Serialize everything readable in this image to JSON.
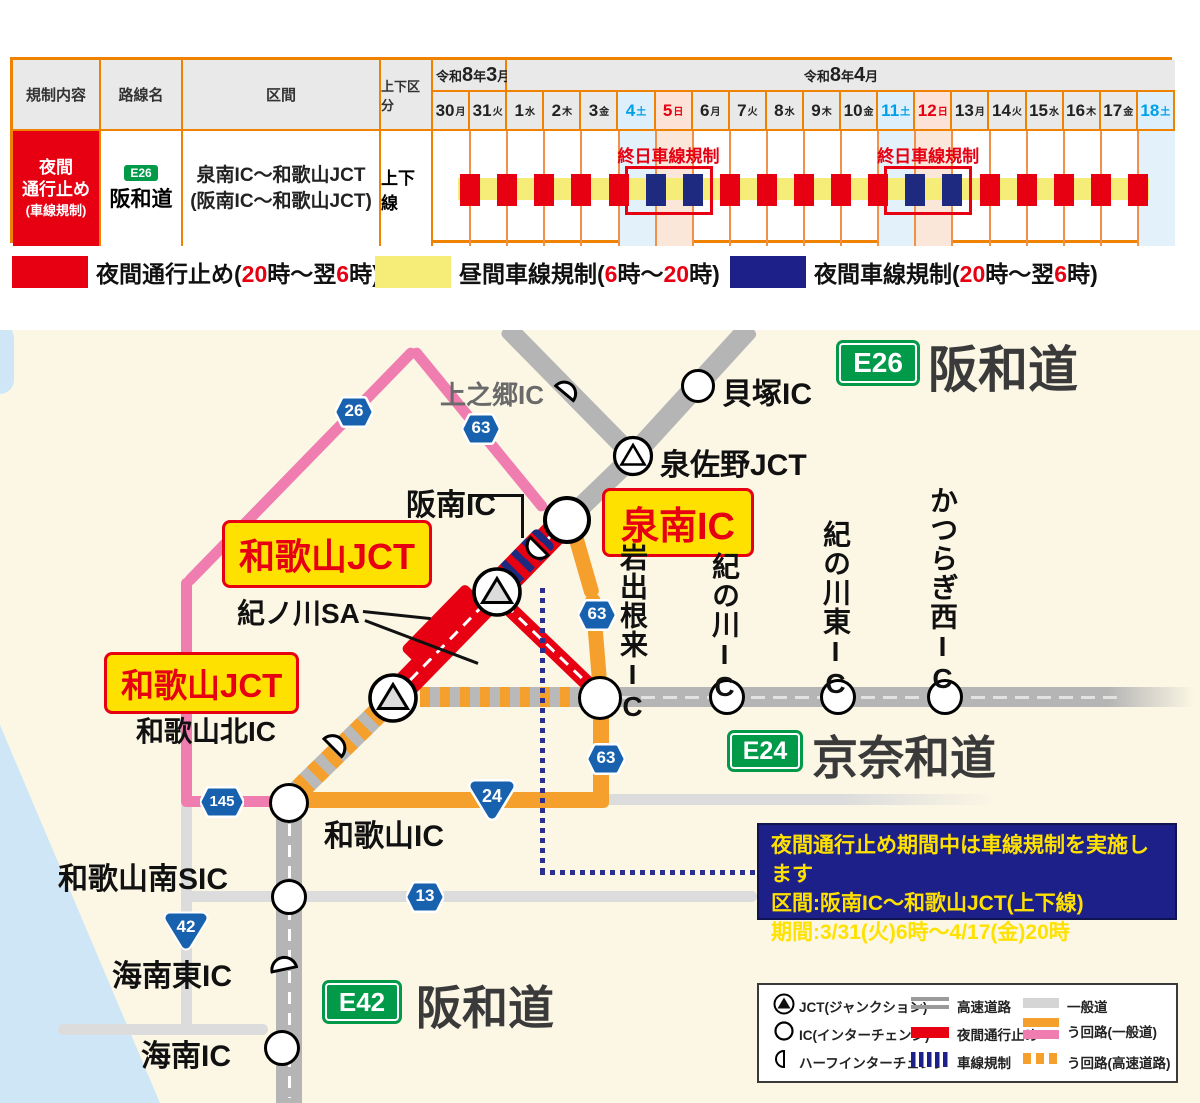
{
  "table": {
    "headers": {
      "regulation": "規制内容",
      "route": "路線名",
      "section": "区間",
      "direction": "上下区分"
    },
    "months": [
      {
        "span": 2,
        "parts": [
          {
            "t": "令和"
          },
          {
            "t": "8",
            "cls": "big"
          },
          {
            "t": "年"
          },
          {
            "t": "3",
            "cls": "big"
          },
          {
            "t": "月"
          }
        ]
      },
      {
        "span": 18,
        "parts": [
          {
            "t": "令和"
          },
          {
            "t": "8",
            "cls": "big"
          },
          {
            "t": "年"
          },
          {
            "t": "4",
            "cls": "big"
          },
          {
            "t": "月"
          }
        ]
      }
    ],
    "dates": [
      {
        "d": "30",
        "w": "月",
        "c": ""
      },
      {
        "d": "31",
        "w": "火",
        "c": ""
      },
      {
        "d": "1",
        "w": "水",
        "c": ""
      },
      {
        "d": "2",
        "w": "木",
        "c": ""
      },
      {
        "d": "3",
        "w": "金",
        "c": ""
      },
      {
        "d": "4",
        "w": "土",
        "c": "sat"
      },
      {
        "d": "5",
        "w": "日",
        "c": "sun"
      },
      {
        "d": "6",
        "w": "月",
        "c": ""
      },
      {
        "d": "7",
        "w": "火",
        "c": ""
      },
      {
        "d": "8",
        "w": "水",
        "c": ""
      },
      {
        "d": "9",
        "w": "木",
        "c": ""
      },
      {
        "d": "10",
        "w": "金",
        "c": ""
      },
      {
        "d": "11",
        "w": "土",
        "c": "sat"
      },
      {
        "d": "12",
        "w": "日",
        "c": "sun"
      },
      {
        "d": "13",
        "w": "月",
        "c": ""
      },
      {
        "d": "14",
        "w": "火",
        "c": ""
      },
      {
        "d": "15",
        "w": "水",
        "c": ""
      },
      {
        "d": "16",
        "w": "木",
        "c": ""
      },
      {
        "d": "17",
        "w": "金",
        "c": ""
      },
      {
        "d": "18",
        "w": "土",
        "c": "sat"
      }
    ],
    "row": {
      "regulation_lines": [
        "夜間",
        "通行止め",
        "(車線規制)"
      ],
      "route_badge": "E26",
      "route_name": "阪和道",
      "section_lines": [
        "泉南IC〜和歌山JCT",
        "(阪南IC〜和歌山JCT)"
      ],
      "direction": "上下線"
    },
    "gantt": {
      "nights": [
        "red",
        "red",
        "red",
        "red",
        "red",
        "blue",
        "blue",
        "red",
        "red",
        "red",
        "red",
        "red",
        "blue",
        "blue",
        "red",
        "red",
        "red",
        "red",
        "red"
      ],
      "highlight_cols": [
        {
          "col": 5,
          "type": "sat"
        },
        {
          "col": 6,
          "type": "sun"
        },
        {
          "col": 12,
          "type": "sat"
        },
        {
          "col": 13,
          "type": "sun"
        },
        {
          "col": 19,
          "type": "sat"
        }
      ],
      "allday_boxes": [
        {
          "from_col": 5
        },
        {
          "from_col": 12
        }
      ],
      "allday_label": "終日車線規制"
    }
  },
  "legend": {
    "items": [
      {
        "color": "#e60012",
        "parts": [
          {
            "t": "夜間通行止め("
          },
          {
            "t": "20",
            "cls": "red"
          },
          {
            "t": "時〜翌"
          },
          {
            "t": "6",
            "cls": "red"
          },
          {
            "t": "時)"
          }
        ]
      },
      {
        "color": "#f5ed77",
        "parts": [
          {
            "t": "昼間車線規制("
          },
          {
            "t": "6",
            "cls": "red"
          },
          {
            "t": "時〜"
          },
          {
            "t": "20",
            "cls": "red"
          },
          {
            "t": "時)"
          }
        ]
      },
      {
        "color": "#1d2088",
        "parts": [
          {
            "t": "夜間車線規制("
          },
          {
            "t": "20",
            "cls": "red"
          },
          {
            "t": "時〜翌"
          },
          {
            "t": "6",
            "cls": "red"
          },
          {
            "t": "時)"
          }
        ]
      }
    ]
  },
  "map": {
    "titles": {
      "e26": {
        "badge": "E26",
        "name": "阪和道"
      },
      "e24": {
        "badge": "E24",
        "name": "京奈和道"
      },
      "e42": {
        "badge": "E42",
        "name": "阪和道"
      }
    },
    "labels": {
      "kaminogo": "上之郷IC",
      "kaizuka": "貝塚IC",
      "izumisano": "泉佐野JCT",
      "hannan": "阪南IC",
      "sennan": "泉南IC",
      "wakayama_jct": "和歌山JCT",
      "kinokawa_sa": "紀ノ川SA",
      "wakayama_kita": "和歌山北IC",
      "iwadene": "岩出根来IC",
      "kinokawa": "紀の川IC",
      "kinokawa_higashi": "紀の川東IC",
      "katsuragi_nishi": "かつらぎ西IC",
      "wakayama": "和歌山IC",
      "wakayama_minami": "和歌山南SIC",
      "kainan_higashi": "海南東IC",
      "kainan": "海南IC"
    },
    "badges": {
      "r26": "26",
      "r63": "63",
      "r145": "145",
      "r24": "24",
      "r42": "42",
      "r13": "13"
    },
    "info_box": {
      "lines": [
        "夜間通行止め期間中は車線規制を実施します",
        "区間:阪南IC〜和歌山JCT(上下線)",
        "期間:3/31(火)6時〜4/17(金)20時"
      ]
    },
    "legend_box": {
      "icons": [
        {
          "icon": "jct-icon",
          "label": "JCT(ジャンクション)"
        },
        {
          "icon": "ic-icon",
          "label": "IC(インターチェンジ)"
        },
        {
          "icon": "half-ic-icon",
          "label": "ハーフインターチェンジ"
        }
      ],
      "roads": [
        {
          "label": "高速道路"
        },
        {
          "label": "夜間通行止め"
        },
        {
          "label": "車線規制"
        }
      ],
      "detours": [
        {
          "label": "一般道"
        },
        {
          "label": "う回路(一般道)"
        },
        {
          "label": "う回路(高速道路)"
        }
      ]
    },
    "colors": {
      "closure": "#e60012",
      "lane_regulation": "#1e2a80",
      "daytime": "#f5ed77",
      "detour_local_orange": "#f5a02d",
      "detour_local_pink": "#f07db0",
      "highway": "#b5b5b5",
      "local_road": "#dcdcdc"
    }
  }
}
